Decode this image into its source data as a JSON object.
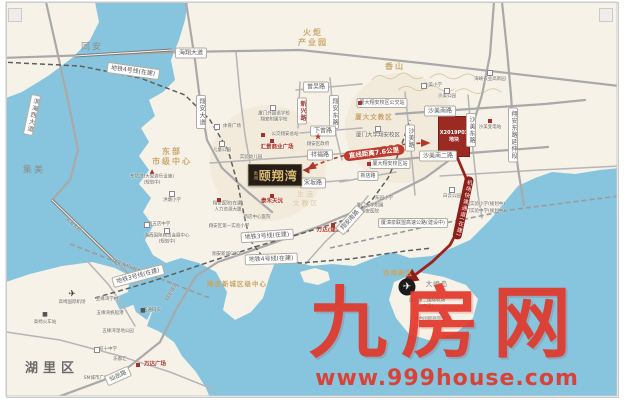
{
  "watermark": {
    "brand": "九房网",
    "url": "www.999house.com"
  },
  "project": {
    "brand": "禹洲",
    "name": "颐翔湾",
    "parcel_line1": "X2019P03",
    "parcel_line2": "地块",
    "distance_badge": "直线距离7.6公里",
    "route_badge": "机场快速通道(在建)"
  },
  "map": {
    "colors": {
      "water": "#86c5dd",
      "land": "#f6f2e8",
      "parcel": "#9b2a22",
      "route": "#9c231c",
      "accent_red": "#c0392e",
      "gold": "#c9a566",
      "watermark_red": "#e2392b"
    },
    "labels": [
      {
        "t": "海翔大道",
        "x": 191,
        "y": 53,
        "c": "pill"
      },
      {
        "t": "地铁4号线(在建)",
        "x": 133,
        "y": 71,
        "c": "pill",
        "r": 8
      },
      {
        "t": "翔安大道",
        "x": 201,
        "y": 112,
        "c": "pillv"
      },
      {
        "t": "滨海西大道",
        "x": 32,
        "y": 115,
        "c": "pillv",
        "r": 12
      },
      {
        "t": "同安",
        "x": 92,
        "y": 48,
        "c": "area"
      },
      {
        "t": "集美",
        "x": 34,
        "y": 171,
        "c": "area"
      },
      {
        "t": "火炬\n产业园",
        "x": 313,
        "y": 38,
        "c": "gold"
      },
      {
        "t": "香山",
        "x": 395,
        "y": 67,
        "c": "gold"
      },
      {
        "t": "曾吴路",
        "x": 316,
        "y": 87,
        "c": "pill"
      },
      {
        "t": "新兴路",
        "x": 302,
        "y": 111,
        "c": "pillvred"
      },
      {
        "t": "翔安东路",
        "x": 334,
        "y": 112,
        "c": "pillv"
      },
      {
        "t": "下曾路",
        "x": 323,
        "y": 131,
        "c": "pill"
      },
      {
        "t": "厦门外国语学校\n翔安附属学校",
        "x": 274,
        "y": 117,
        "c": "poism"
      },
      {
        "t": "公交翔安总站",
        "x": 285,
        "y": 135,
        "c": "poism"
      },
      {
        "t": "汇景商业广场",
        "x": 277,
        "y": 148,
        "c": "poired"
      },
      {
        "t": "翔安区政府",
        "x": 318,
        "y": 145,
        "c": "poism"
      },
      {
        "t": "祥福路",
        "x": 320,
        "y": 155,
        "c": "pill"
      },
      {
        "t": "体育广场",
        "x": 232,
        "y": 127,
        "c": "poism"
      },
      {
        "t": "儿童公园",
        "x": 222,
        "y": 151,
        "c": "poism"
      },
      {
        "t": "实验幼儿园",
        "x": 251,
        "y": 158,
        "c": "poism"
      },
      {
        "t": "厦大文教区",
        "x": 374,
        "y": 117,
        "c": "goldsm"
      },
      {
        "t": "厦门大学翔安校区",
        "x": 378,
        "y": 136,
        "c": "poi"
      },
      {
        "t": "厦大翔安校区公交站",
        "x": 382,
        "y": 103,
        "c": "pillsm"
      },
      {
        "t": "沙美小学",
        "x": 433,
        "y": 86,
        "c": "poism"
      },
      {
        "t": "沙美公园",
        "x": 447,
        "y": 97,
        "c": "poism"
      },
      {
        "t": "海峡农业高新园",
        "x": 490,
        "y": 80,
        "c": "poism"
      },
      {
        "t": "沙美南路",
        "x": 440,
        "y": 111,
        "c": "pill"
      },
      {
        "t": "沙美路",
        "x": 410,
        "y": 138,
        "c": "pillv"
      },
      {
        "t": "沙美东路",
        "x": 471,
        "y": 130,
        "c": "pillv"
      },
      {
        "t": "翔安东路延伸段",
        "x": 513,
        "y": 135,
        "c": "pillv"
      },
      {
        "t": "沙美变电站",
        "x": 490,
        "y": 128,
        "c": "poism"
      },
      {
        "t": "沙美南二路",
        "x": 438,
        "y": 156,
        "c": "pill"
      },
      {
        "t": "宋坂路",
        "x": 313,
        "y": 183,
        "c": "pill"
      },
      {
        "t": "新店路",
        "x": 368,
        "y": 176,
        "c": "pillsm"
      },
      {
        "t": "厦大翔安校区站",
        "x": 390,
        "y": 164,
        "c": "pillsm"
      },
      {
        "t": "东园小学",
        "x": 384,
        "y": 199,
        "c": "poism"
      },
      {
        "t": "厦门大学附属\n翔安医院",
        "x": 370,
        "y": 209,
        "c": "poism"
      },
      {
        "t": "白云公园",
        "x": 452,
        "y": 197,
        "c": "poism"
      },
      {
        "t": "厦门实验小学(规划中)",
        "x": 483,
        "y": 205,
        "c": "poism"
      },
      {
        "t": "厦门实验中学(规划中)",
        "x": 483,
        "y": 212,
        "c": "poism"
      },
      {
        "t": "生活\n文教区",
        "x": 306,
        "y": 199,
        "c": "goldfaint"
      },
      {
        "t": "泰禾天沅",
        "x": 272,
        "y": 202,
        "c": "poired"
      },
      {
        "t": "翔安医院(在建)\n人力资源大厦",
        "x": 228,
        "y": 207,
        "c": "poism"
      },
      {
        "t": "新店中心医院",
        "x": 257,
        "y": 218,
        "c": "poism"
      },
      {
        "t": "翔安区第一实验小学",
        "x": 229,
        "y": 227,
        "c": "poism"
      },
      {
        "t": "地铁3号线(在建)",
        "x": 267,
        "y": 236,
        "c": "pill",
        "r": -4
      },
      {
        "t": "地铁4号线(在建)",
        "x": 271,
        "y": 259,
        "c": "pill",
        "r": -2
      },
      {
        "t": "翔安新城CBD",
        "x": 226,
        "y": 255,
        "c": "poism"
      },
      {
        "t": "万达(建设中)",
        "x": 333,
        "y": 231,
        "c": "poired"
      },
      {
        "t": "翔安南路",
        "x": 350,
        "y": 220,
        "c": "pill",
        "r": -48
      },
      {
        "t": "厦漳泉联盟高速公路(建设中)",
        "x": 413,
        "y": 223,
        "c": "pillsm"
      },
      {
        "t": "东部\n市级中心",
        "x": 172,
        "y": 157,
        "c": "gold"
      },
      {
        "t": "东坑湾(大型游乐设施)\n(规划中)",
        "x": 152,
        "y": 180,
        "c": "poism"
      },
      {
        "t": "洪塘小学",
        "x": 172,
        "y": 201,
        "c": "poism"
      },
      {
        "t": "刘五店中学",
        "x": 159,
        "y": 225,
        "c": "poism"
      },
      {
        "t": "海西国际商贸会展中心\n(规划中)",
        "x": 167,
        "y": 239,
        "c": "poism"
      },
      {
        "t": "滨海大桥",
        "x": 73,
        "y": 225,
        "c": "tiny",
        "r": 42
      },
      {
        "t": "翔安大桥(规划中)",
        "x": 130,
        "y": 268,
        "c": "tiny",
        "r": 22
      },
      {
        "t": "地铁3号线(在建)",
        "x": 138,
        "y": 276,
        "c": "pill",
        "r": -15
      },
      {
        "t": "翔安隧道",
        "x": 172,
        "y": 292,
        "c": "tiny",
        "r": -62
      },
      {
        "t": "翔安新城区级中心",
        "x": 237,
        "y": 284,
        "c": "goldsm"
      },
      {
        "t": "空港新区",
        "x": 398,
        "y": 273,
        "c": "goldsm"
      },
      {
        "t": "湖里区",
        "x": 52,
        "y": 369,
        "c": "areabig"
      },
      {
        "t": "高崎国际机场",
        "x": 72,
        "y": 303,
        "c": "poism"
      },
      {
        "t": "高崎火车站",
        "x": 45,
        "y": 323,
        "c": "poism"
      },
      {
        "t": "五缘湾学村",
        "x": 107,
        "y": 300,
        "c": "poism"
      },
      {
        "t": "五缘湾帆船港",
        "x": 110,
        "y": 314,
        "c": "poism"
      },
      {
        "t": "五缘湾湿地公园",
        "x": 118,
        "y": 332,
        "c": "poism"
      },
      {
        "t": "五通码头",
        "x": 152,
        "y": 311,
        "c": "poism"
      },
      {
        "t": "双十中学",
        "x": 108,
        "y": 350,
        "c": "poism"
      },
      {
        "t": "乐都汇",
        "x": 120,
        "y": 360,
        "c": "poism"
      },
      {
        "t": "SM城市广场",
        "x": 96,
        "y": 379,
        "c": "poism"
      },
      {
        "t": "万达广场",
        "x": 155,
        "y": 365,
        "c": "poired"
      },
      {
        "t": "仙岳路",
        "x": 118,
        "y": 376,
        "c": "pill",
        "r": -24
      },
      {
        "t": "大嶝岛",
        "x": 437,
        "y": 284,
        "c": "islandname"
      },
      {
        "t": "厦门第二国际机场\n(在建)",
        "x": 427,
        "y": 304,
        "c": "poism"
      },
      {
        "t": "对台国际商贸区",
        "x": 430,
        "y": 320,
        "c": "poism"
      },
      {
        "t": "直线距离7.6公里",
        "x": 374,
        "y": 153,
        "c": "badge",
        "r": -7
      },
      {
        "t": "机场快速通道(在建)",
        "x": 463,
        "y": 208,
        "c": "route",
        "r": 12
      }
    ],
    "icons": [
      {
        "n": "school-icon",
        "cls": "i-gray",
        "x": 273,
        "y": 108
      },
      {
        "n": "school-icon",
        "cls": "i-gray",
        "x": 378,
        "y": 129
      },
      {
        "n": "school-icon",
        "cls": "i-gray",
        "x": 424,
        "y": 86
      },
      {
        "n": "school-icon",
        "cls": "i-gray",
        "x": 172,
        "y": 194
      },
      {
        "n": "school-icon",
        "cls": "i-gray",
        "x": 147,
        "y": 225
      },
      {
        "n": "school-icon",
        "cls": "i-gray",
        "x": 97,
        "y": 350
      },
      {
        "n": "park-icon",
        "cls": "i-gray",
        "x": 222,
        "y": 144
      },
      {
        "n": "park-icon",
        "cls": "i-gray",
        "x": 217,
        "y": 127
      },
      {
        "n": "park-icon",
        "cls": "i-gray",
        "x": 447,
        "y": 91
      },
      {
        "n": "park-icon",
        "cls": "i-gray",
        "x": 452,
        "y": 190
      },
      {
        "n": "park-icon",
        "cls": "i-gray",
        "x": 167,
        "y": 231
      },
      {
        "n": "park-icon",
        "cls": "i-gray",
        "x": 490,
        "y": 73
      },
      {
        "n": "mall-icon",
        "cls": "i-red",
        "x": 272,
        "y": 141
      },
      {
        "n": "bus-icon",
        "cls": "i-red",
        "x": 263,
        "y": 135
      },
      {
        "n": "bus-icon",
        "cls": "i-red",
        "x": 360,
        "y": 103
      },
      {
        "n": "metro-station-icon",
        "cls": "i-red",
        "x": 369,
        "y": 164
      },
      {
        "n": "mall-icon",
        "cls": "i-red",
        "x": 272,
        "y": 196
      },
      {
        "n": "mall-icon",
        "cls": "i-red",
        "x": 333,
        "y": 225
      },
      {
        "n": "mall-icon",
        "cls": "i-red",
        "x": 138,
        "y": 365
      },
      {
        "n": "power-icon",
        "cls": "i-red",
        "x": 490,
        "y": 121
      },
      {
        "n": "hospital-icon",
        "cls": "i-red",
        "x": 219,
        "y": 200
      },
      {
        "n": "gov-star-icon",
        "cls": "i-star",
        "x": 318,
        "y": 138,
        "g": "★"
      },
      {
        "n": "attraction-icon",
        "cls": "i-tri",
        "x": 152,
        "y": 172,
        "g": "▲"
      },
      {
        "n": "plane-icon",
        "cls": "i-plane",
        "x": 72,
        "y": 295,
        "g": "✈"
      },
      {
        "n": "train-icon",
        "cls": "i-sq",
        "x": 45,
        "y": 315,
        "g": "■"
      },
      {
        "n": "ferry-icon",
        "cls": "i-sq",
        "x": 143,
        "y": 311,
        "g": "■"
      },
      {
        "n": "new-airport-icon",
        "cls": "i-plane-big",
        "x": 407,
        "y": 287,
        "g": "✈"
      },
      {
        "n": "arrow-left-icon",
        "cls": "i-arrow",
        "x": 306,
        "y": 171,
        "g": "◀"
      }
    ]
  }
}
